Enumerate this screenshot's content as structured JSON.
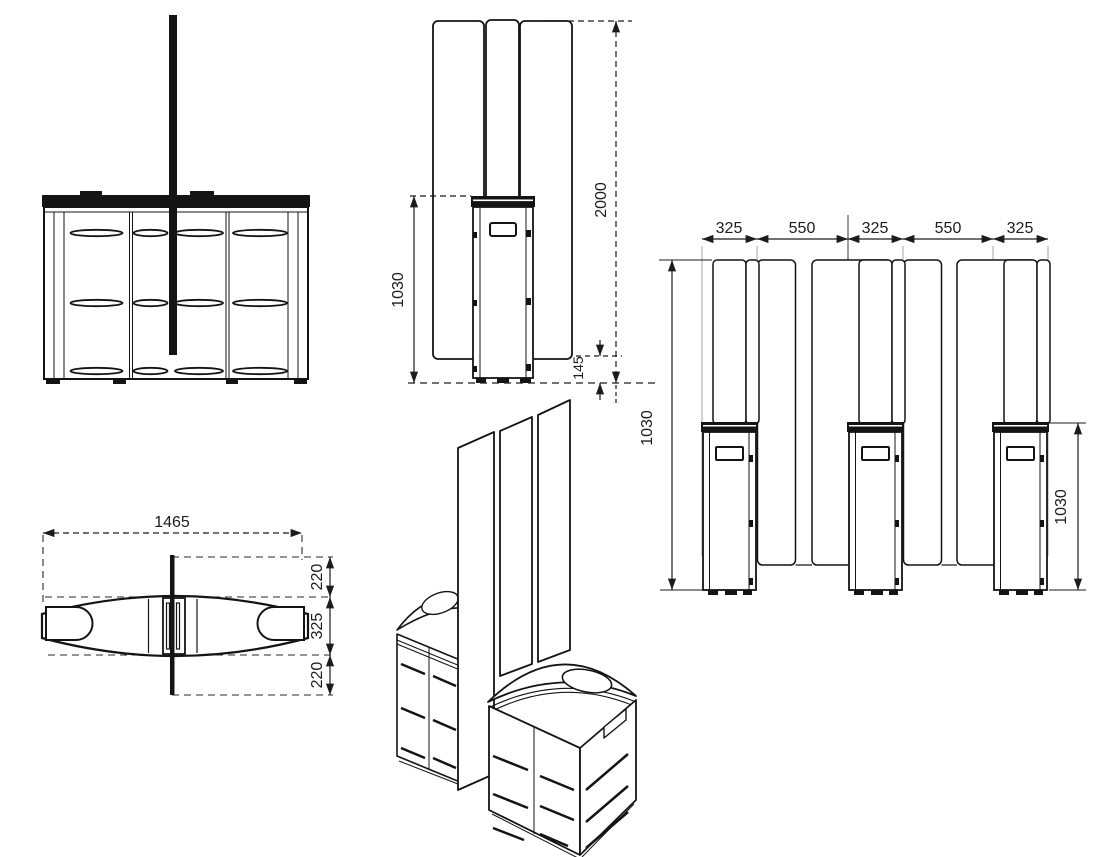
{
  "drawing": {
    "side_view": {
      "pedestal_height": "1030",
      "total_height": "2000",
      "glass_floor_gap": "145"
    },
    "lanes_view": {
      "top_dims": [
        "325",
        "550",
        "325",
        "550",
        "325"
      ],
      "left_height": "1030",
      "right_height": "1030"
    },
    "plan_view": {
      "overall_width": "1465",
      "top_offset": "220",
      "depth": "325",
      "bottom_offset": "220"
    }
  }
}
